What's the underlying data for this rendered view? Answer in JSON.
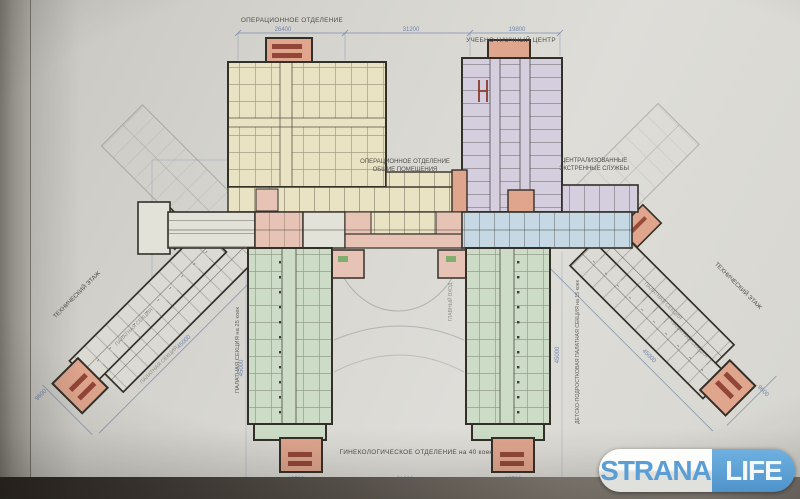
{
  "colors": {
    "paper": "#d6d5cf",
    "wall": "#332f29",
    "yellow": "#eae3c3",
    "purple": "#d5cede",
    "green": "#cddcc6",
    "blue_room": "#c5d8e3",
    "pink": "#e6c3b4",
    "salmon": "#dfa58d",
    "dark_red": "#8a3c2d",
    "gray_wing": "#dbdad4",
    "pale_room": "#e3e2d8",
    "dim": "#7286ae",
    "label": "#504d48",
    "arc": "#8a9090",
    "logo_blue": "#5b9ed6"
  },
  "labels": {
    "op_dept_top": "ОПЕРАЦИОННОЕ ОТДЕЛЕНИЕ",
    "science_center": "УЧЕБНО-НАУЧНЫЙ ЦЕНТР",
    "op_common_line1": "ОПЕРАЦИОННОЕ ОТДЕЛЕНИЕ",
    "op_common_line2": "ОБЩИЕ ПОМЕЩЕНИЯ",
    "emergency_line1": "ЦЕНТРАЛИЗОВАННЫЕ",
    "emergency_line2": "ЭКСТРЕННЫЕ СЛУЖБЫ",
    "tech_floor": "ТЕХНИЧЕСКИЙ ЭТАЖ",
    "ward_section_left": "ПАЛАТНАЯ СЕКЦИЯ на 25 коек",
    "ward_section_right": "ДЕТСКО-ПОДРОСТКОВАЯ ПАЛАТНАЯ СЕКЦИЯ на 15 коек",
    "gynecology": "ГИНЕКОЛОГИЧЕСКОЕ ОТДЕЛЕНИЕ на 40 коек",
    "wing_inner": "ПАЛАТНАЯ СЕКЦИЯ",
    "main_entrance": "ГЛАВНЫЙ ВХОД"
  },
  "dimensions": {
    "top": [
      "26400",
      "31200",
      "19800"
    ],
    "bottom": [
      "19500",
      "31200",
      "19500"
    ],
    "wing_length": "45000",
    "wing_end": "9600",
    "side_left": "45000",
    "side_right": "45000"
  },
  "logo": {
    "strana": "STRANA",
    "life": "LIFE"
  }
}
